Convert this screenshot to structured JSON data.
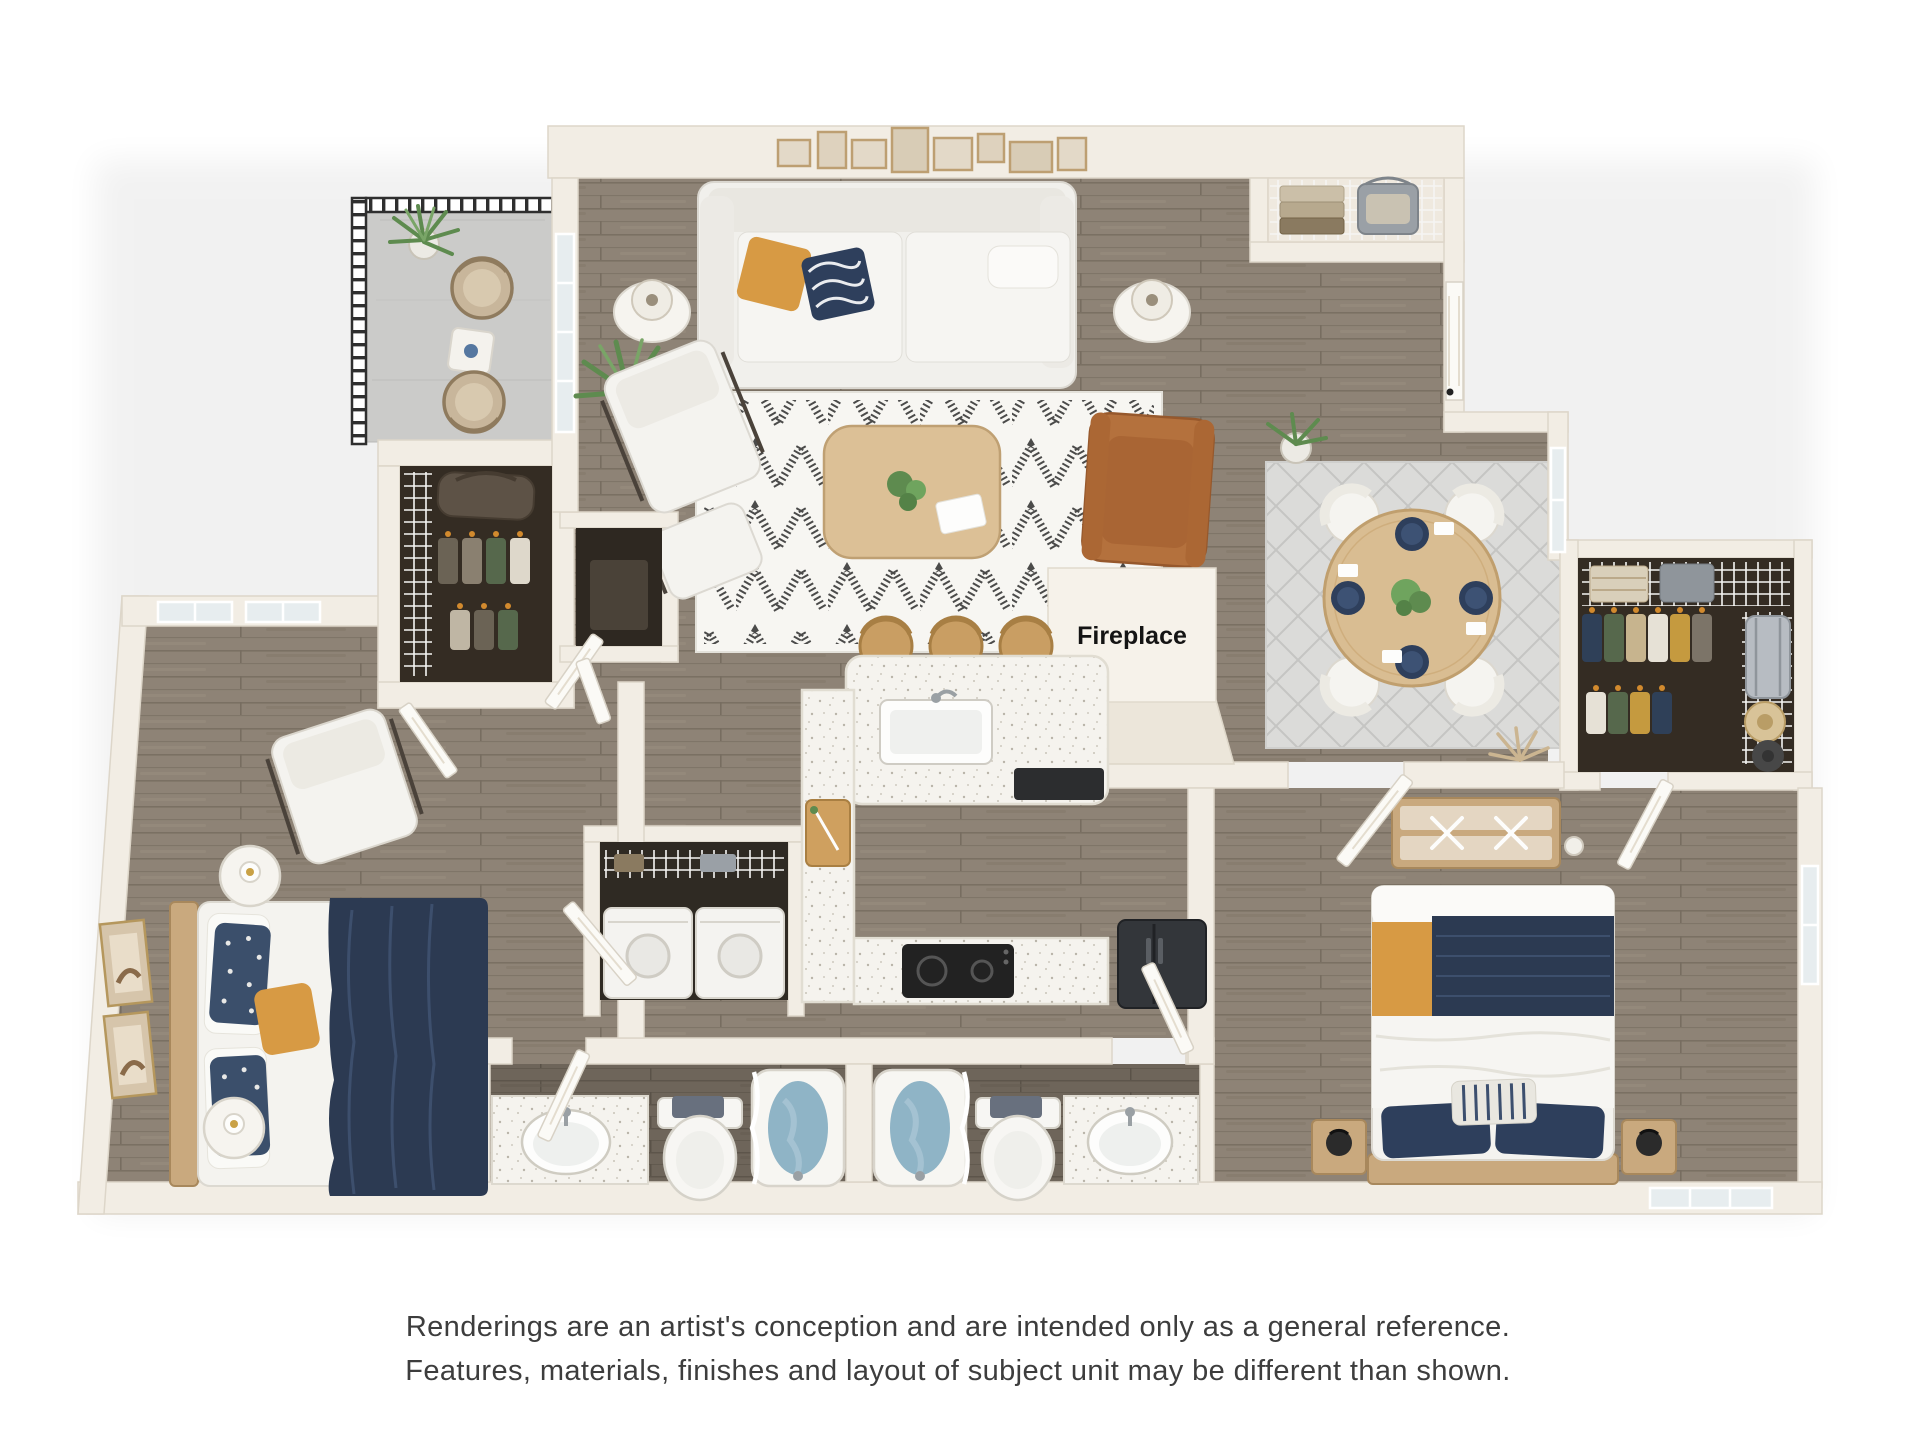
{
  "title": "3D apartment floor plan rendering",
  "fireplace_label": "Fireplace",
  "disclaimer": {
    "line1": "Renderings are an artist's conception and are intended only as a general reference.",
    "line2": "Features, materials, finishes and layout of subject unit may be different than shown."
  },
  "palette": {
    "background": "#ffffff",
    "wall": "#f2ede4",
    "wall_edge": "#ddd6c9",
    "wood_floor": "#8e8376",
    "wood_floor_dark": "#6e655a",
    "balcony_concrete": "#cbcbc9",
    "closet_floor": "#342c23",
    "railing_black": "#2f2f2f",
    "rug_living": "#f7f6f2",
    "rug_dining": "#dbdbd9",
    "sofa_white": "#f2f1ed",
    "accent_orange": "#d79a44",
    "accent_navy": "#2e3f5c",
    "leather_tan": "#b4713d",
    "table_wood": "#d9bd92",
    "counter_speckle": "#f5f3ee",
    "tub_water_blue": "#8fb4c6",
    "plant_green": "#5e8b4f",
    "appliance_dark": "#33363a",
    "text_dark": "#3d3d3d"
  },
  "rooms": [
    {
      "name": "balcony",
      "items": [
        "potted-plant",
        "wicker-chair",
        "wicker-chair",
        "side-table",
        "metal-railing"
      ]
    },
    {
      "name": "living-room",
      "items": [
        "gallery-wall-art",
        "sofa",
        "orange-pillow",
        "navy-pattern-pillow",
        "table-lamp",
        "table-lamp",
        "palm-plant",
        "lounge-chair",
        "ottoman",
        "coffee-table",
        "leather-armchair",
        "chevron-rug"
      ]
    },
    {
      "name": "kitchen",
      "items": [
        "island-breakfast-bar",
        "bar-stool",
        "bar-stool",
        "bar-stool",
        "sink",
        "dishwasher",
        "cutting-board",
        "cooktop",
        "refrigerator"
      ]
    },
    {
      "name": "dining-area",
      "items": [
        "round-dining-table",
        "dining-chair",
        "dining-chair",
        "dining-chair",
        "dining-chair",
        "place-settings",
        "diamond-rug",
        "potted-plant",
        "dried-grass-decor"
      ]
    },
    {
      "name": "fireplace",
      "items": [
        "fireplace-box"
      ]
    },
    {
      "name": "linen-closet",
      "items": [
        "wire-shelf",
        "folded-towels",
        "storage-basket"
      ]
    },
    {
      "name": "entry",
      "items": [
        "entry-door"
      ]
    },
    {
      "name": "walk-in-closet",
      "items": [
        "wire-shelf",
        "hanging-clothes",
        "suitcase",
        "hats",
        "folded-towels",
        "basket"
      ]
    },
    {
      "name": "bedroom-2",
      "items": [
        "bed",
        "nightstand",
        "nightstand",
        "lamp",
        "lamp",
        "dresser",
        "window",
        "window"
      ]
    },
    {
      "name": "bathroom-1",
      "items": [
        "vanity-sink",
        "toilet",
        "bathtub",
        "shower-curtain",
        "door"
      ]
    },
    {
      "name": "bathroom-2",
      "items": [
        "bathtub",
        "toilet",
        "vanity-sink",
        "shower-curtain",
        "door"
      ]
    },
    {
      "name": "laundry",
      "items": [
        "washer",
        "dryer",
        "wire-shelf"
      ]
    },
    {
      "name": "bedroom-1",
      "items": [
        "bed",
        "nightstand",
        "nightstand",
        "lounge-chair",
        "wall-art",
        "wall-art",
        "window",
        "window",
        "closet-with-clothes",
        "duffel-bag"
      ]
    },
    {
      "name": "utility-closet",
      "items": [
        "door"
      ]
    }
  ]
}
